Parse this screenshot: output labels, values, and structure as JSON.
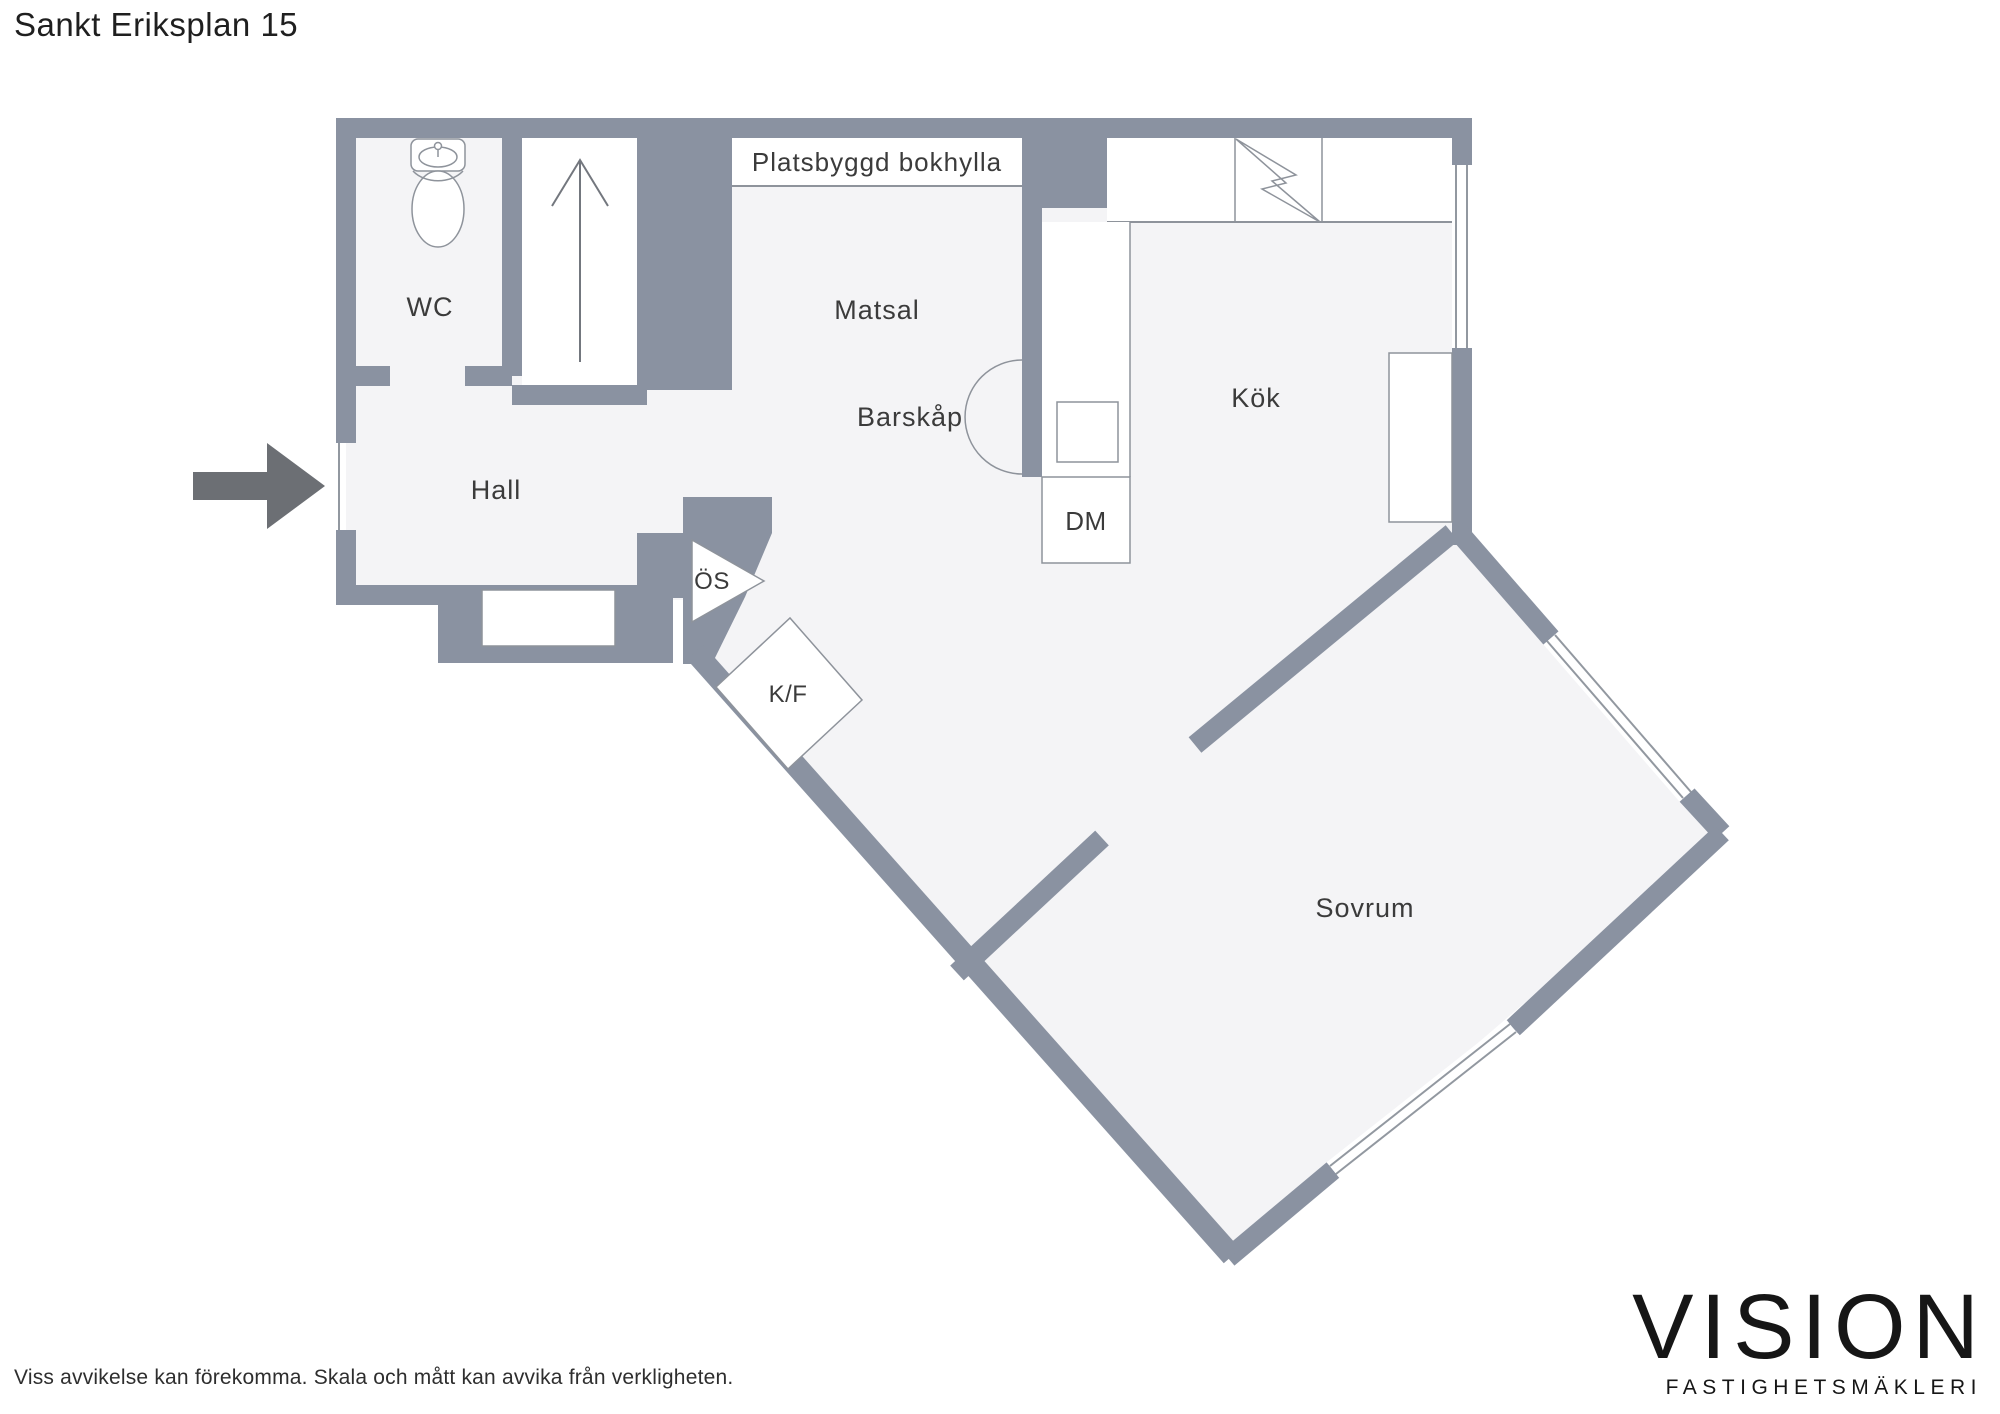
{
  "title": "Sankt Eriksplan 15",
  "disclaimer": "Viss avvikelse kan förekomma. Skala och mått kan avvika från verkligheten.",
  "logo": {
    "name": "VISION",
    "tagline": "FASTIGHETSMÄKLERI"
  },
  "colors": {
    "wall": "#8A92A1",
    "floor": "#F4F4F6",
    "fixture_line": "#8E939B",
    "label_text": "#3B3B3B",
    "entry_arrow": "#6C6F74",
    "page_background": "#FFFFFF",
    "logo_text": "#161616"
  },
  "labels": {
    "wc": "WC",
    "hall": "Hall",
    "matsal": "Matsal",
    "kok": "Kök",
    "sovrum": "Sovrum",
    "barskap": "Barskåp",
    "bokhylla": "Platsbyggd bokhylla",
    "dm": "DM",
    "os": "ÖS",
    "kf": "K/F"
  },
  "icons": [
    "toilet-icon",
    "stairs-up-arrow-icon",
    "entry-arrow-icon",
    "stove-lightning-icon",
    "sink-icon",
    "window-icon",
    "barskap-arc-icon"
  ]
}
